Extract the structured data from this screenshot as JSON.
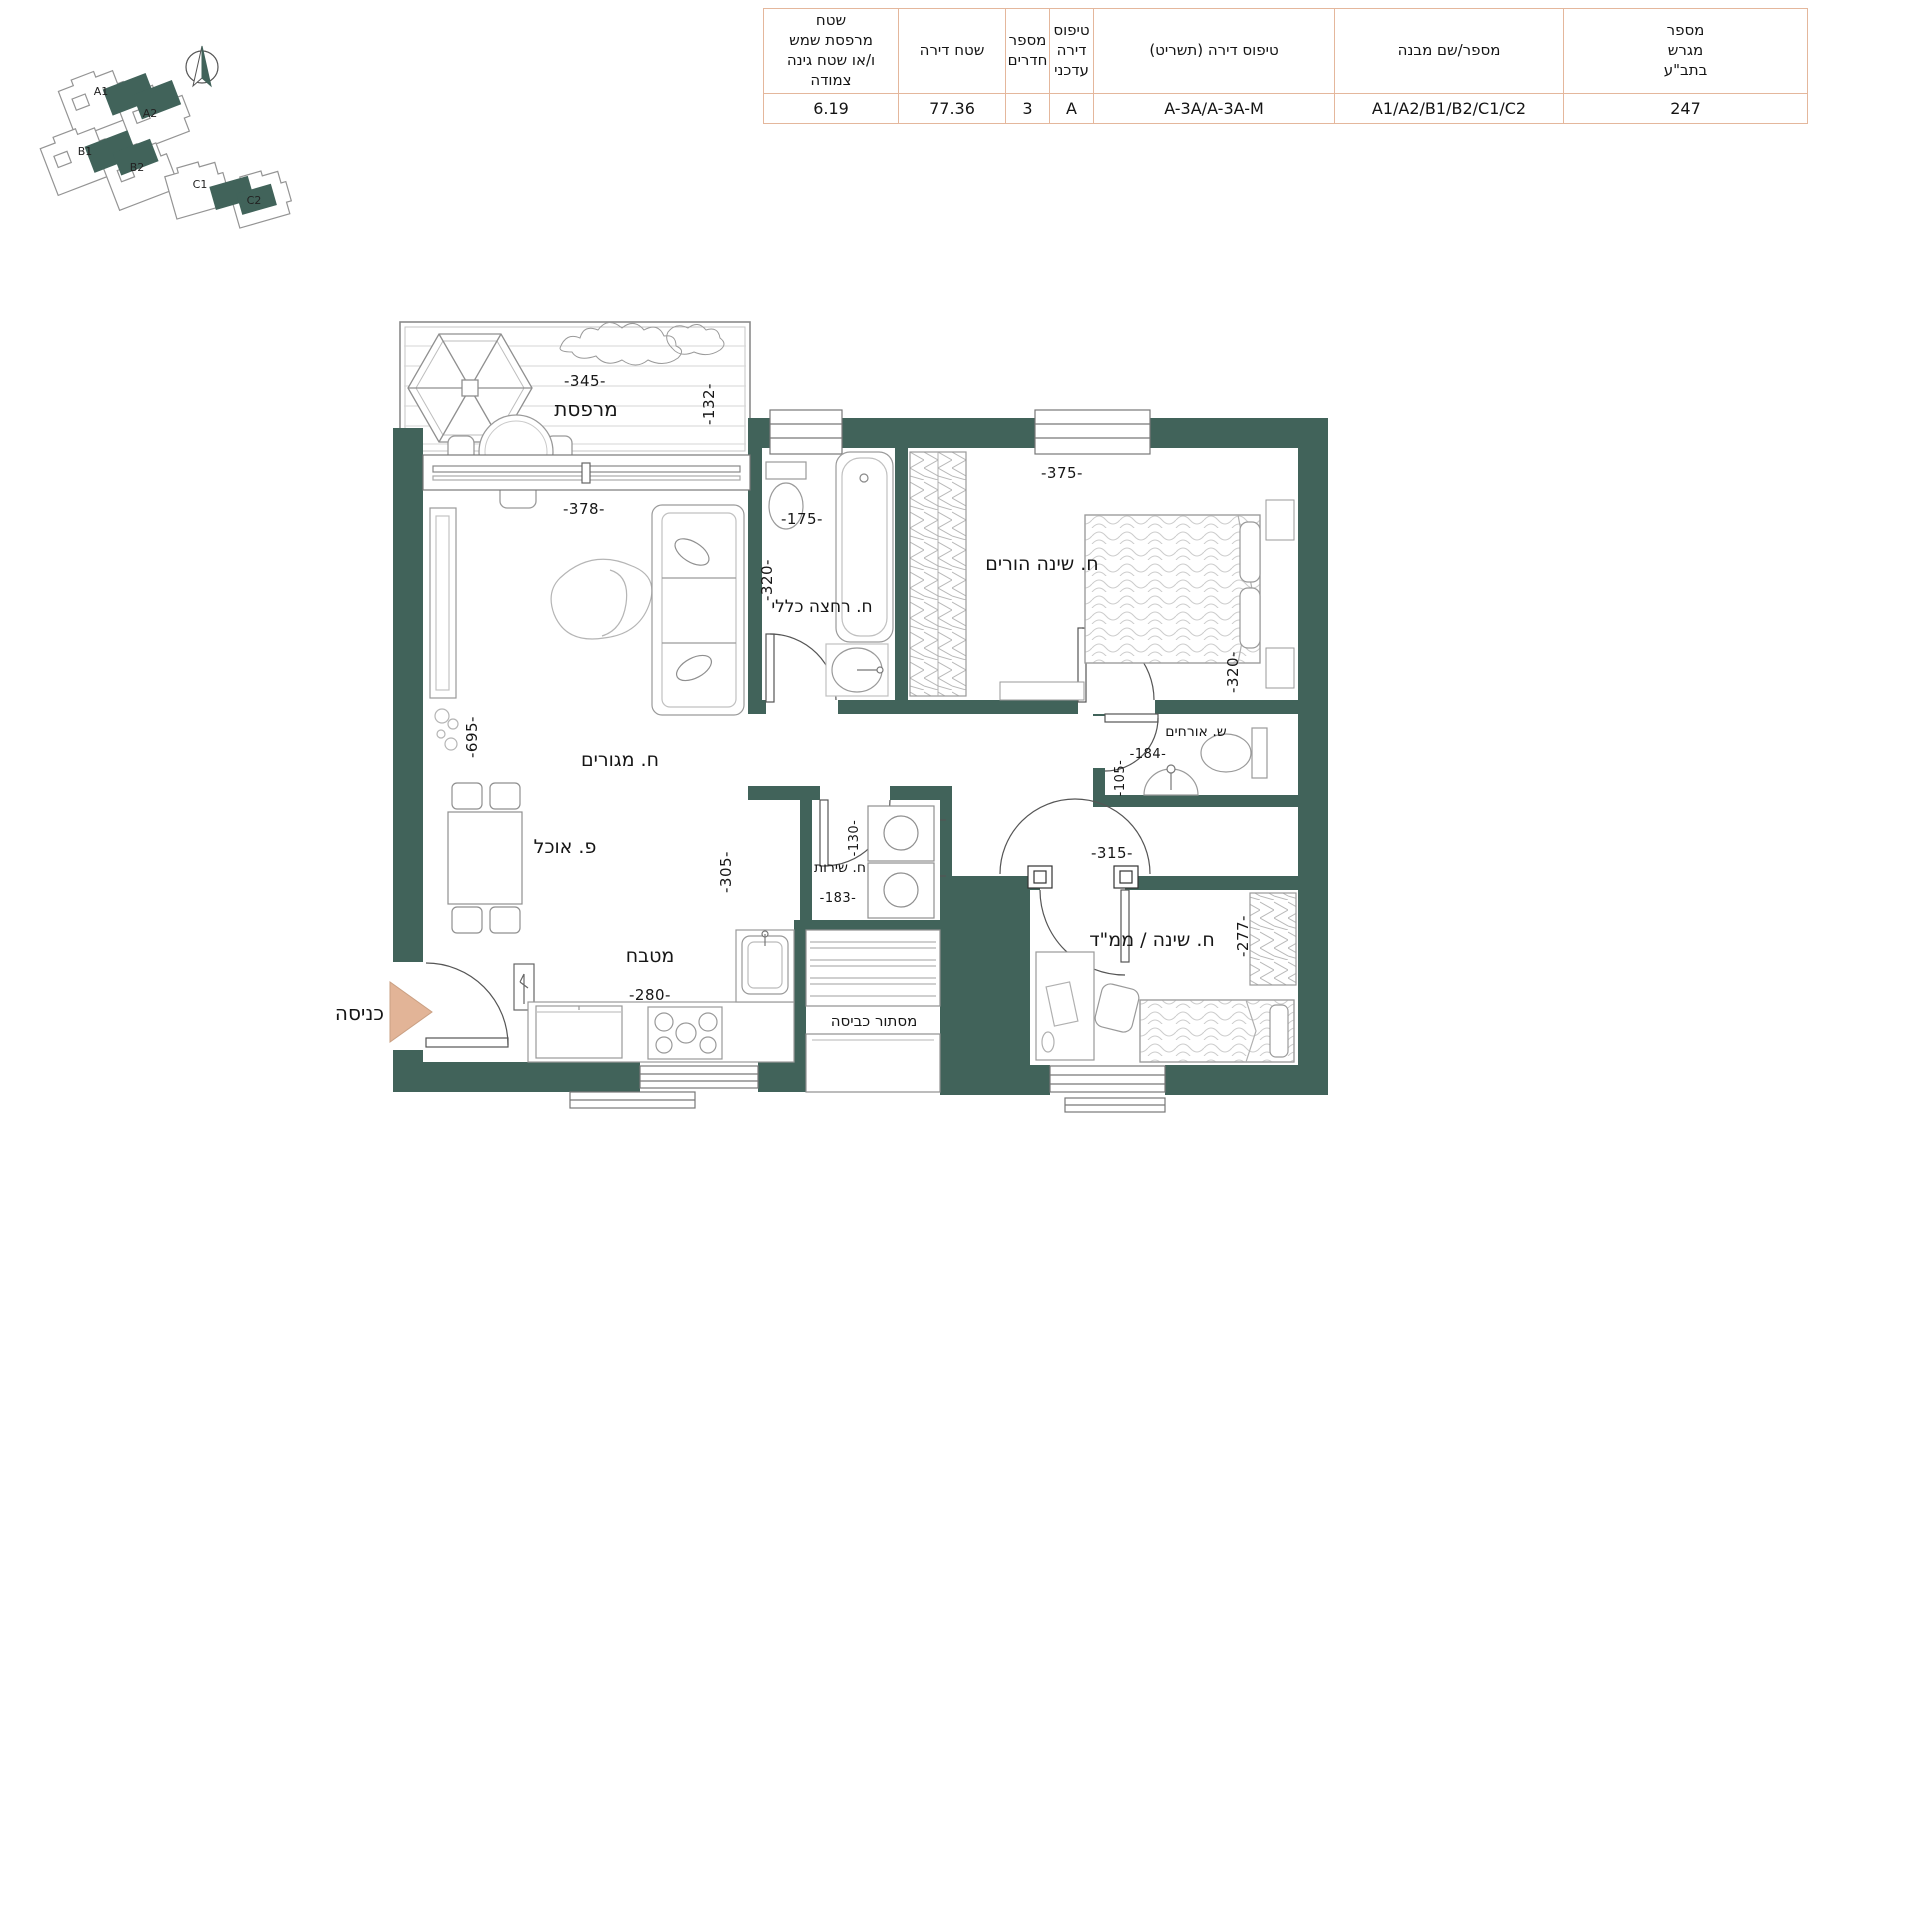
{
  "header_table": {
    "columns": [
      {
        "header": "שטח\nמרפסת שמש\nו/או שטח גינה צמודה",
        "value": "6.19"
      },
      {
        "header": "שטח דירה",
        "value": "77.36"
      },
      {
        "header": "מספר\nחדרים",
        "value": "3"
      },
      {
        "header": "טיפוס\nדירה\nעדכני",
        "value": "A"
      },
      {
        "header": "טיפוס דירה (תשריט)",
        "value": "A-3A/A-3A-M"
      },
      {
        "header": "מספר/שם מבנה",
        "value": "A1/A2/B1/B2/C1/C2"
      },
      {
        "header": "מספר\nמגרש\nבתב\"ע",
        "value": "247"
      }
    ]
  },
  "site_plan": {
    "buildings": [
      "A1",
      "A2",
      "B1",
      "B2",
      "C1",
      "C2"
    ]
  },
  "floor_plan": {
    "entrance_label": "כניסה",
    "rooms": {
      "balcony": {
        "name": "מרפסת",
        "dim_width": "-345-",
        "dim_depth": "-132-"
      },
      "living": {
        "name": "ח. מגורים",
        "dim_width": "-378-",
        "dim_height": "-695-"
      },
      "dining": {
        "name": "פ. אוכל"
      },
      "kitchen": {
        "name": "מטבח",
        "dim_width": "-280-",
        "dim_side": "-305-"
      },
      "bathroom": {
        "name": "ח. רחצה כללי",
        "dim_width": "-175-",
        "dim_height": "-320-"
      },
      "master_bedroom": {
        "name": "ח. שינה הורים",
        "dim_width": "-375-",
        "dim_height": "-320-"
      },
      "guest_wc": {
        "name": "ש. אורחים",
        "dim_width": "-184-",
        "dim_height": "-105-"
      },
      "service": {
        "name": "ח. שירות",
        "dim_width": "-183-",
        "dim_height": "-130-"
      },
      "laundry": {
        "name": "מסתור כביסה"
      },
      "mamad": {
        "name": "ח. שינה / ממ\"ד",
        "dim_width": "-315-",
        "dim_height": "-277-"
      }
    }
  },
  "colors": {
    "wall": "#41635A",
    "table_border": "#E4B79C",
    "entrance_arrow": "#E2B497"
  }
}
